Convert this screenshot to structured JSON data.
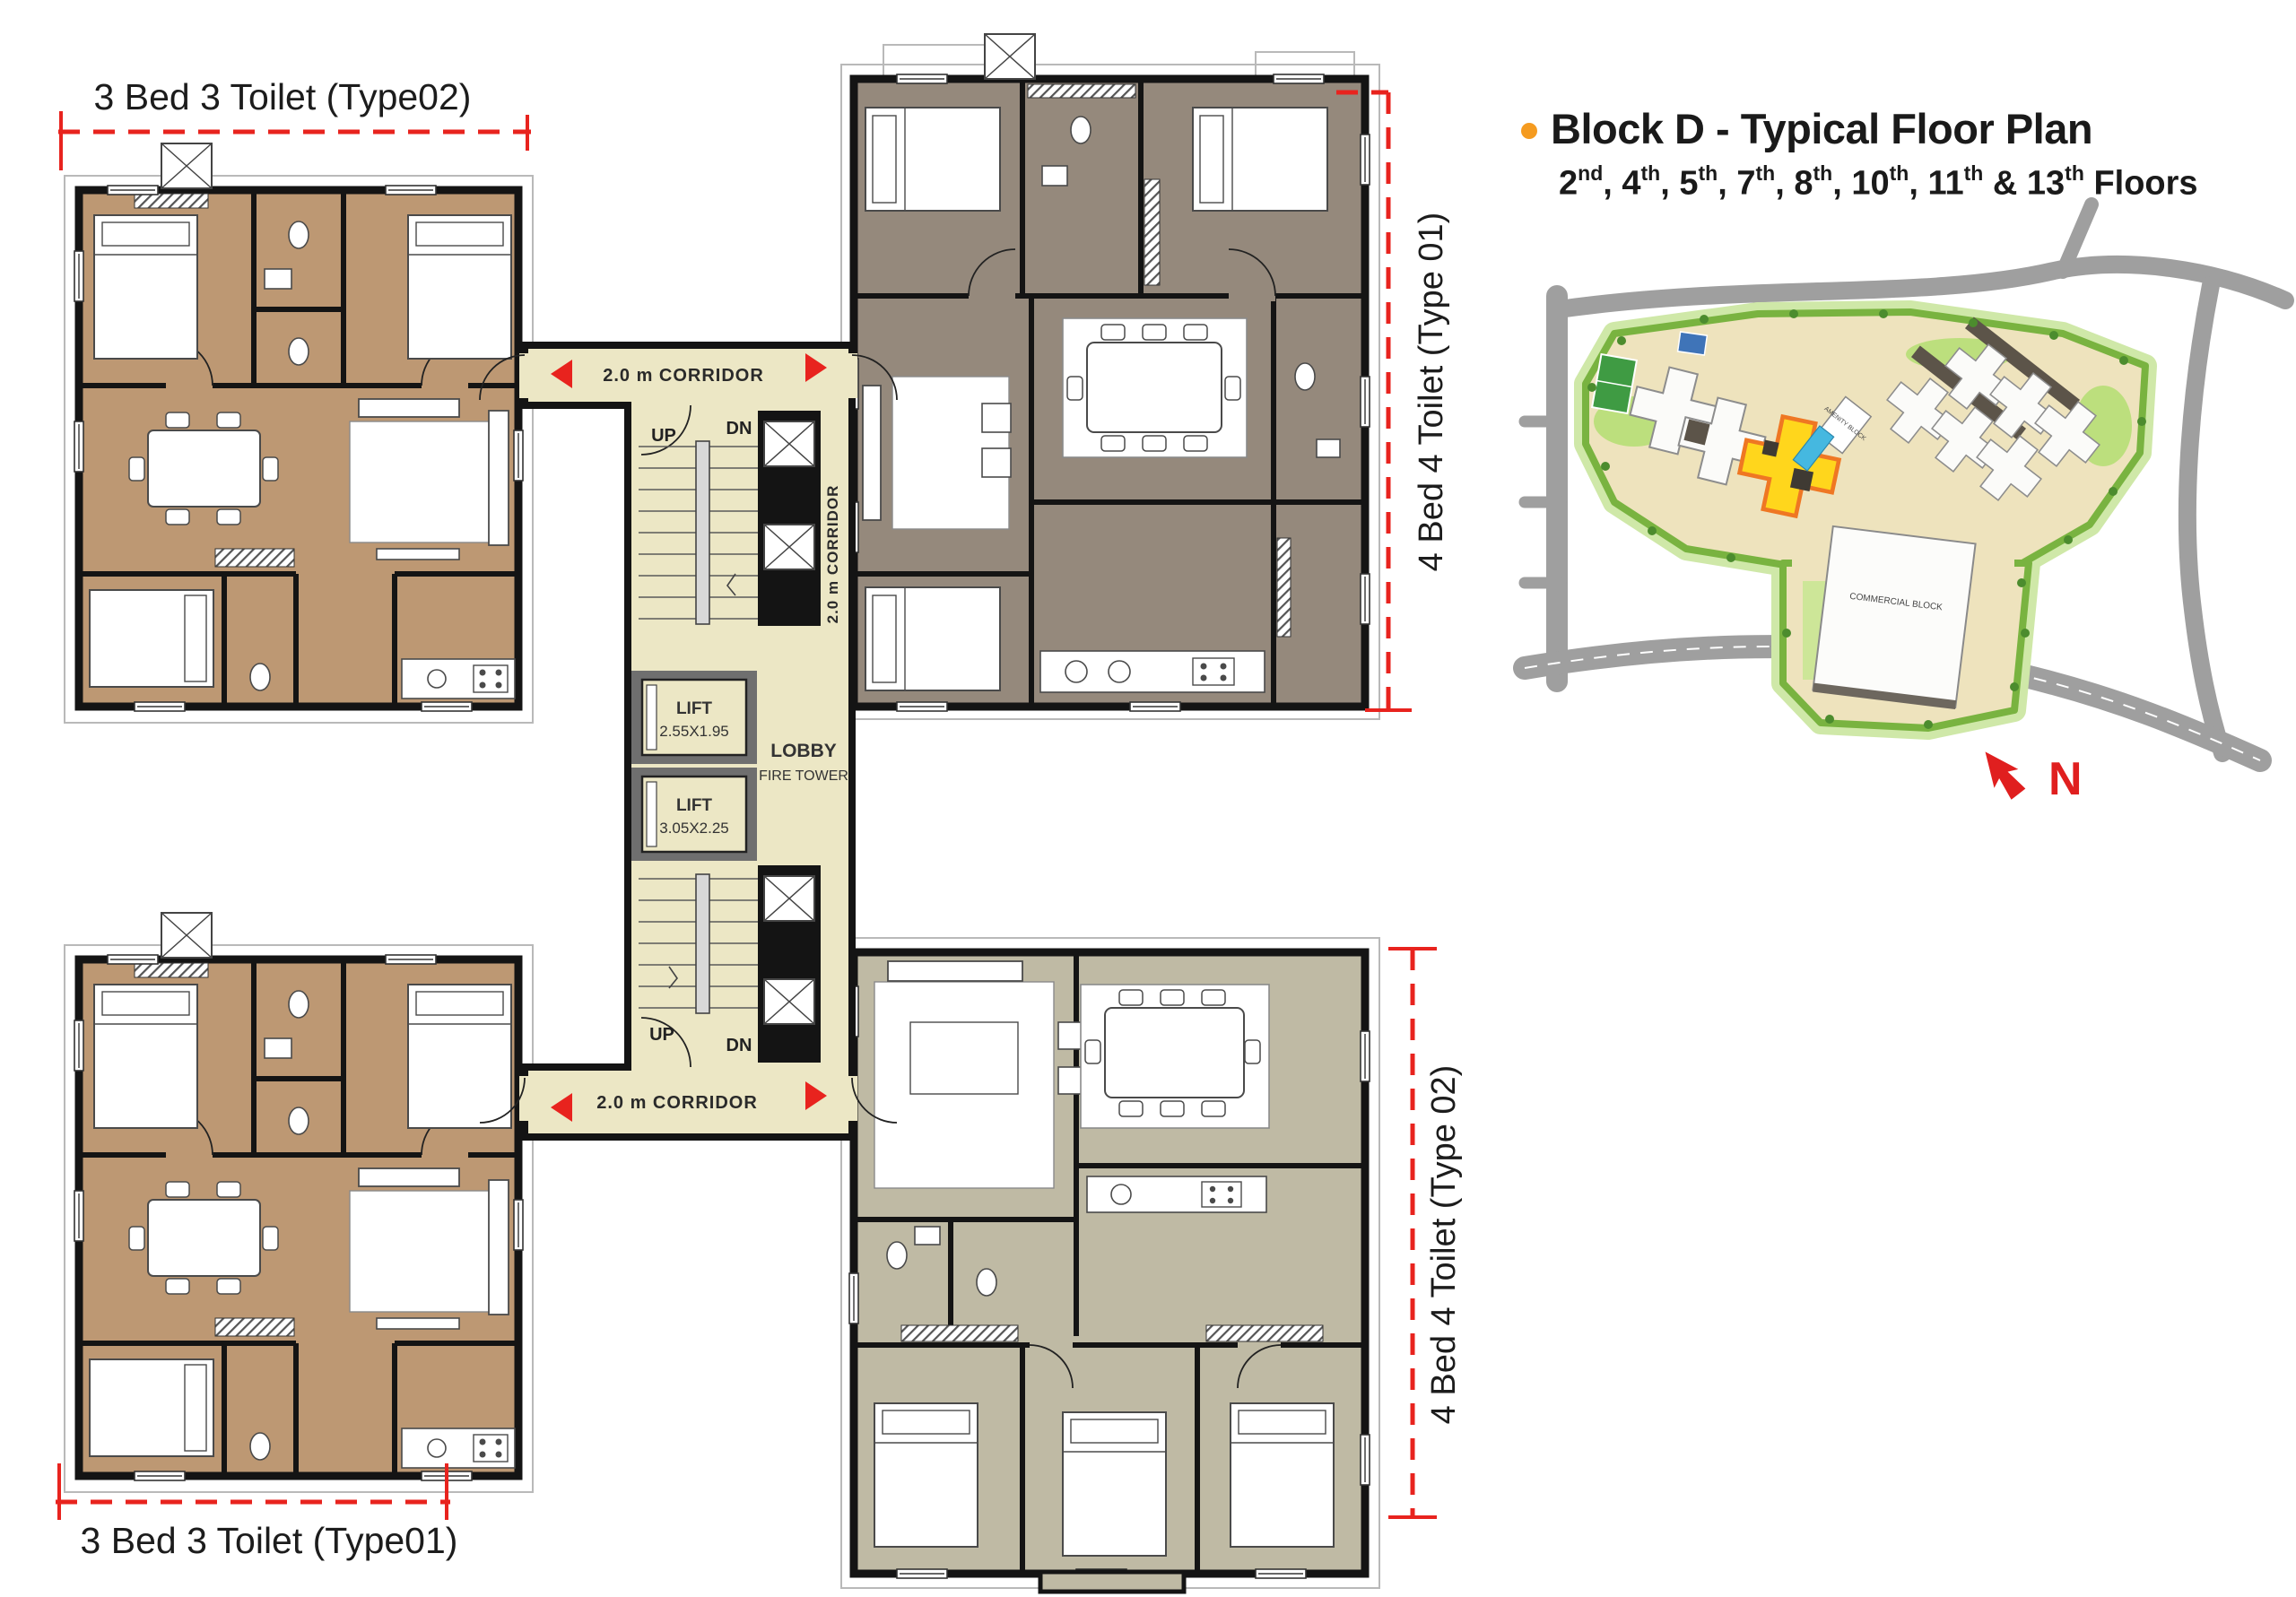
{
  "info_panel": {
    "title": "Block D - Typical Floor Plan",
    "bullet_color": "#f59b20",
    "floors": [
      {
        "num": "2",
        "suffix": "nd",
        "after": ", "
      },
      {
        "num": "4",
        "suffix": "th",
        "after": ", "
      },
      {
        "num": "5",
        "suffix": "th",
        "after": ", "
      },
      {
        "num": "7",
        "suffix": "th",
        "after": ", "
      },
      {
        "num": "8",
        "suffix": "th",
        "after": ", "
      },
      {
        "num": "10",
        "suffix": "th",
        "after": ", "
      },
      {
        "num": "11",
        "suffix": "th",
        "after": " & "
      },
      {
        "num": "13",
        "suffix": "th",
        "after": " Floors"
      }
    ]
  },
  "floor_plan": {
    "units": [
      {
        "id": "top-left",
        "label": "3 Bed 3 Toilet (Type02)",
        "floor_color": "#bd9873"
      },
      {
        "id": "top-right",
        "label": "4 Bed 4 Toilet (Type 01)",
        "floor_color": "#95897c"
      },
      {
        "id": "bottom-left",
        "label": "3 Bed 3 Toilet (Type01)",
        "floor_color": "#bd9873"
      },
      {
        "id": "bottom-right",
        "label": "4 Bed 4 Toilet (Type 02)",
        "floor_color": "#bfbaa4"
      }
    ],
    "core": {
      "corridor_top": "2.0 m CORRIDOR",
      "corridor_bottom": "2.0 m CORRIDOR",
      "corridor_vertical": "2.0 m CORRIDOR",
      "stair_top": {
        "up": "UP",
        "dn": "DN"
      },
      "stair_bottom": {
        "up": "UP",
        "dn": "DN"
      },
      "lifts": [
        {
          "label": "LIFT",
          "size": "2.55X1.95"
        },
        {
          "label": "LIFT",
          "size": "3.05X2.25"
        }
      ],
      "lobby": "LOBBY",
      "fire_tower": "FIRE TOWER",
      "corridor_color": "#ece7c5",
      "wall_color": "#141414",
      "marker_red": "#e8231e"
    }
  },
  "site_map": {
    "commercial_block": "COMMERCIAL BLOCK",
    "amenity_block": "AMENITY BLOCK",
    "north": "N",
    "highlight_color": "#ffd61c"
  }
}
